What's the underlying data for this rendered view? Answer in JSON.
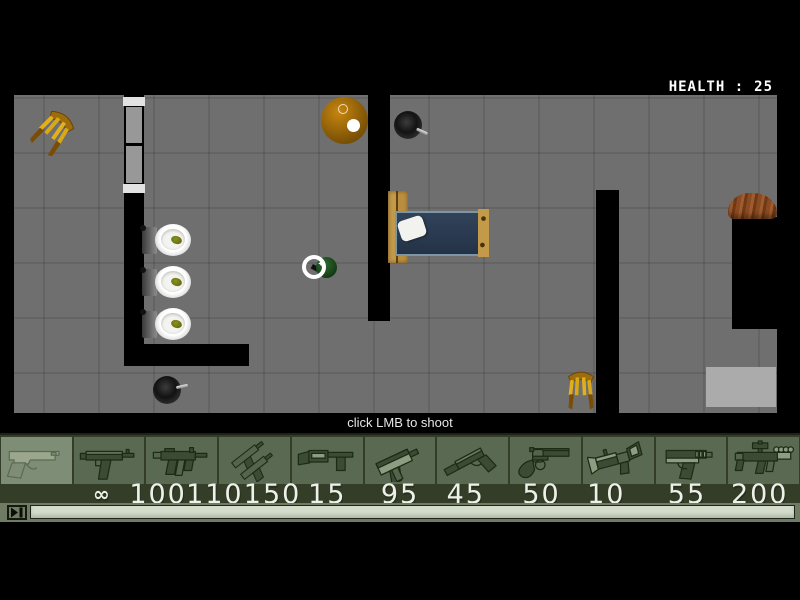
{
  "hud": {
    "health_label": "HEALTH :",
    "health_value": "25",
    "hint": "click LMB to shoot"
  },
  "weapons": [
    {
      "name": "desert-eagle",
      "ammo": "∞",
      "selected": true
    },
    {
      "name": "uzi",
      "ammo": "100",
      "selected": false
    },
    {
      "name": "mp5",
      "ammo": "110",
      "selected": false
    },
    {
      "name": "dual-tmps",
      "ammo": "150",
      "selected": false
    },
    {
      "name": "shotgun",
      "ammo": "15",
      "selected": false
    },
    {
      "name": "mac-10",
      "ammo": "95",
      "selected": false
    },
    {
      "name": "silenced-pistol",
      "ammo": "45",
      "selected": false
    },
    {
      "name": "revolver",
      "ammo": "50",
      "selected": false
    },
    {
      "name": "grenade-launcher",
      "ammo": "10",
      "selected": false
    },
    {
      "name": "p99-pistol",
      "ammo": "55",
      "selected": false
    },
    {
      "name": "scoped-rifle",
      "ammo": "200",
      "selected": false
    }
  ],
  "map": {
    "objects": [
      "chair",
      "door",
      "toilet",
      "toilet",
      "toilet",
      "round-table-with-lamp",
      "frying-pan",
      "bed",
      "player-character",
      "crosshair-cursor",
      "chair",
      "rug",
      "wooden-table",
      "frying-pan"
    ]
  },
  "transport": {
    "button_icon": "play-pause"
  },
  "colors": {
    "floor": "#6f6f6f",
    "wall": "#000000",
    "bar_bg": "#333d28",
    "slot_bg": "#5a6a52",
    "slot_selected_bg": "#7e8e76",
    "ammo_text": "#eef1e9",
    "chair_wood": "#e2b01c",
    "bed_blanket": "#2c3d50",
    "health_text": "#ffffff"
  }
}
